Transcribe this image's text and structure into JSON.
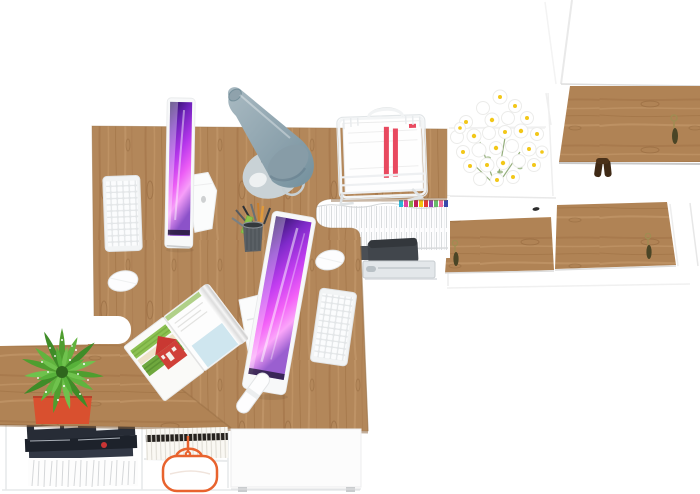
{
  "scene": {
    "title": "top-down 3d render of a white and oak corner office workspace",
    "background": "#ffffff",
    "palette": {
      "wood": "#b3875a",
      "wood_shadow": "#8a6239",
      "wood_grain_dark": "#9c6f42",
      "wood_grain_light": "#c9a071",
      "screen_magenta": "#e14df2",
      "screen_deep_purple": "#241056",
      "lamp_gray_blue": "#879ca7",
      "lamp_base_gray": "#c9d2d6",
      "pot_orange_red": "#d9502f",
      "plant_green": "#57b13a",
      "daisy_yellow": "#f2c718",
      "paper_stripe_red": "#e8495f",
      "bag_trim_orange": "#e8632e",
      "magazine_cover_dark": "#272c36",
      "printer_dark_gray": "#41464c",
      "key_tassel_olive": "#4a4526",
      "dark_ornament_brown": "#3f2a16"
    },
    "file_tabs": [
      "#29b6d8",
      "#e040a0",
      "#7cb342",
      "#c2185b",
      "#f4c20d",
      "#e53935",
      "#8e44ad",
      "#66bb6a",
      "#ef6c9a",
      "#3949ab"
    ],
    "counts": {
      "monitors": 2,
      "keyboards": 2,
      "mice": 2,
      "cabinet_keys": 3,
      "wood_doors": 3
    },
    "objects": [
      "l-shaped-oak-desk-top",
      "lower-oak-bench-top",
      "white-sideboard",
      "tall-white-cabinet",
      "upper-wood-cabinet-door",
      "mid-wood-door-left",
      "mid-wood-door-right",
      "imac-monitor-1",
      "imac-monitor-2",
      "white-keyboard-1",
      "white-keyboard-2",
      "white-mouse-1",
      "white-mouse-2",
      "cone-desk-lamp",
      "wire-paper-tray",
      "striped-papers",
      "daisy-bouquet",
      "succulent-plant-orange-pot",
      "open-landscape-magazine",
      "white-marker-pen",
      "pen-cup",
      "hanging-file-folders",
      "color-index-tabs",
      "printer-in-shelf",
      "metal-drawer",
      "magazine-stack",
      "fanned-pages",
      "row-of-booklets",
      "orange-trim-pouch",
      "white-drawer-front",
      "door-keys-with-tassels",
      "dark-wood-ornament"
    ]
  }
}
